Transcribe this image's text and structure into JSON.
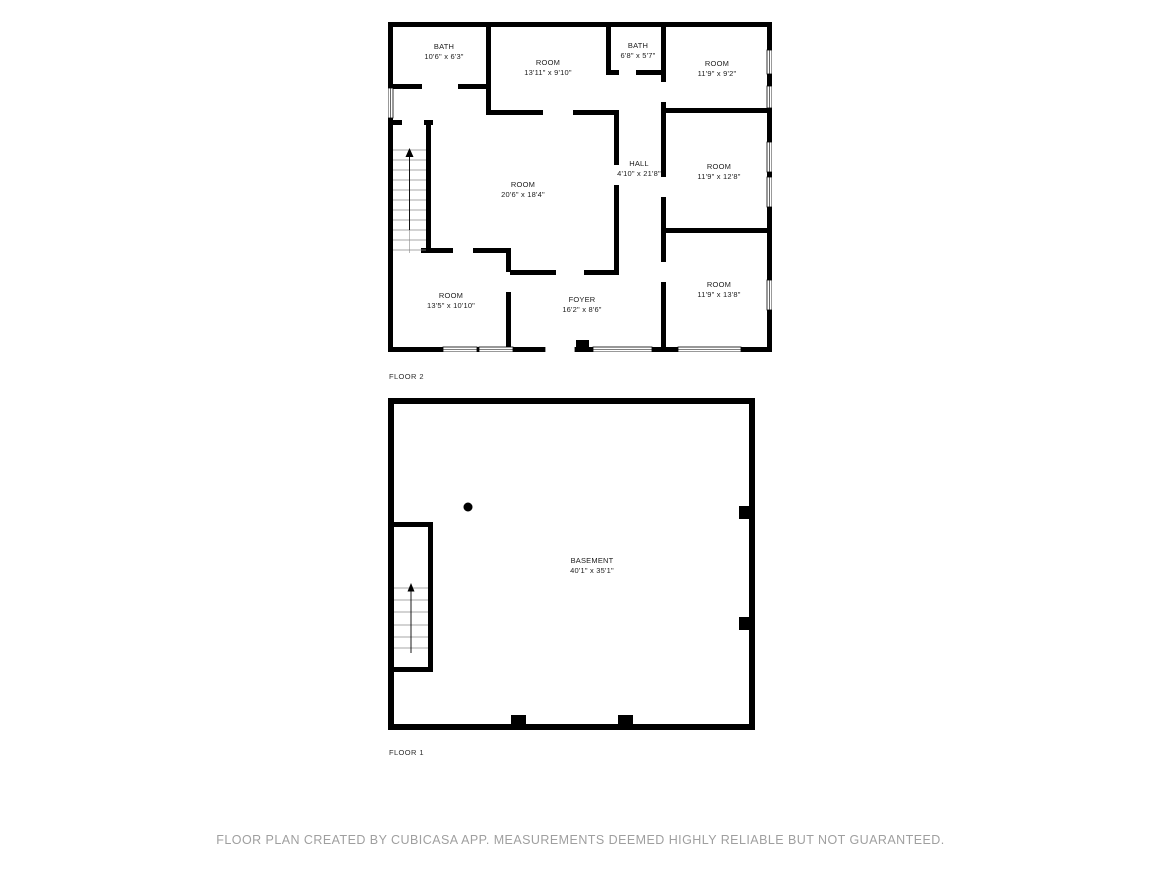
{
  "colors": {
    "wall": "#000000",
    "label_text": "#1c1c1c",
    "caption_text": "#2b2b2b",
    "footer_text": "#9f9f9f",
    "background": "#ffffff"
  },
  "floors": [
    {
      "label": "FLOOR 2",
      "rooms": [
        {
          "name": "BATH",
          "dims": "10'6\" x 6'3\""
        },
        {
          "name": "ROOM",
          "dims": "13'11\" x 9'10\""
        },
        {
          "name": "BATH",
          "dims": "6'8\" x 5'7\""
        },
        {
          "name": "ROOM",
          "dims": "11'9\" x 9'2\""
        },
        {
          "name": "HALL",
          "dims": "4'10\" x 21'8\""
        },
        {
          "name": "ROOM",
          "dims": "20'6\" x 18'4\""
        },
        {
          "name": "ROOM",
          "dims": "11'9\" x 12'8\""
        },
        {
          "name": "ROOM",
          "dims": "13'5\" x 10'10\""
        },
        {
          "name": "FOYER",
          "dims": "16'2\" x 8'6\""
        },
        {
          "name": "ROOM",
          "dims": "11'9\" x 13'8\""
        }
      ]
    },
    {
      "label": "FLOOR 1",
      "rooms": [
        {
          "name": "BASEMENT",
          "dims": "40'1\" x 35'1\""
        }
      ]
    }
  ],
  "footer": {
    "disclaimer": "FLOOR PLAN CREATED BY CUBICASA APP. MEASUREMENTS DEEMED HIGHLY RELIABLE BUT NOT GUARANTEED."
  }
}
